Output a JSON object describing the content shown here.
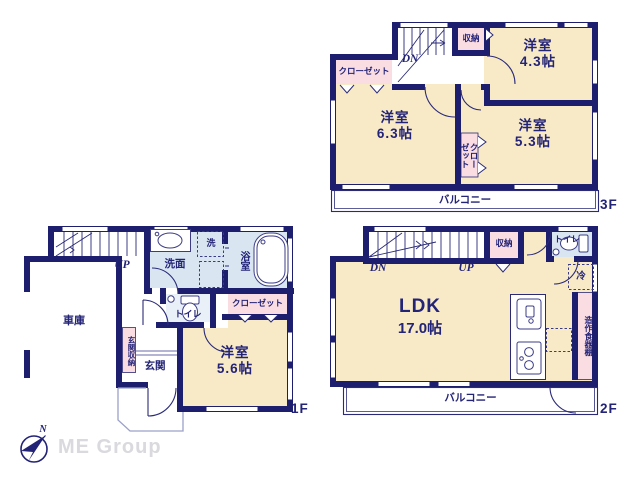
{
  "f3": {
    "floor_label": "3F",
    "room_a_name": "洋室",
    "room_a_size": "4.3帖",
    "room_b_name": "洋室",
    "room_b_size": "6.3帖",
    "room_c_name": "洋室",
    "room_c_size": "5.3帖",
    "closet": "クローゼット",
    "closet_mid": "クロー\nゼット",
    "storage": "収納",
    "stairs_dn": "DN",
    "balcony": "バルコニー"
  },
  "f2": {
    "floor_label": "2F",
    "ldk_name": "LDK",
    "ldk_size": "17.0帖",
    "storage": "収納",
    "toilet": "トイレ",
    "fridge": "冷",
    "cupboard": "造作食器棚",
    "stairs_dn": "DN",
    "stairs_up": "UP",
    "balcony": "バルコニー"
  },
  "f1": {
    "floor_label": "1F",
    "garage": "車庫",
    "stairs_up": "UP",
    "washroom": "洗面",
    "laundry": "洗",
    "bath": "浴室",
    "closet": "クローゼット",
    "toilet": "トイレ",
    "entrance_storage": "玄関収納",
    "entrance": "玄関",
    "bedroom_name": "洋室",
    "bedroom_size": "5.6帖"
  },
  "compass": {
    "north_label": "N"
  },
  "watermark": "ME Group",
  "colors": {
    "wall_navy": "#1e1e6e",
    "room_cream": "#f8eac6",
    "closet_pink": "#fadde2",
    "wet_blue": "#d9e6f2",
    "text_navy": "#232377",
    "watermark_gray": "#d9d9de"
  }
}
